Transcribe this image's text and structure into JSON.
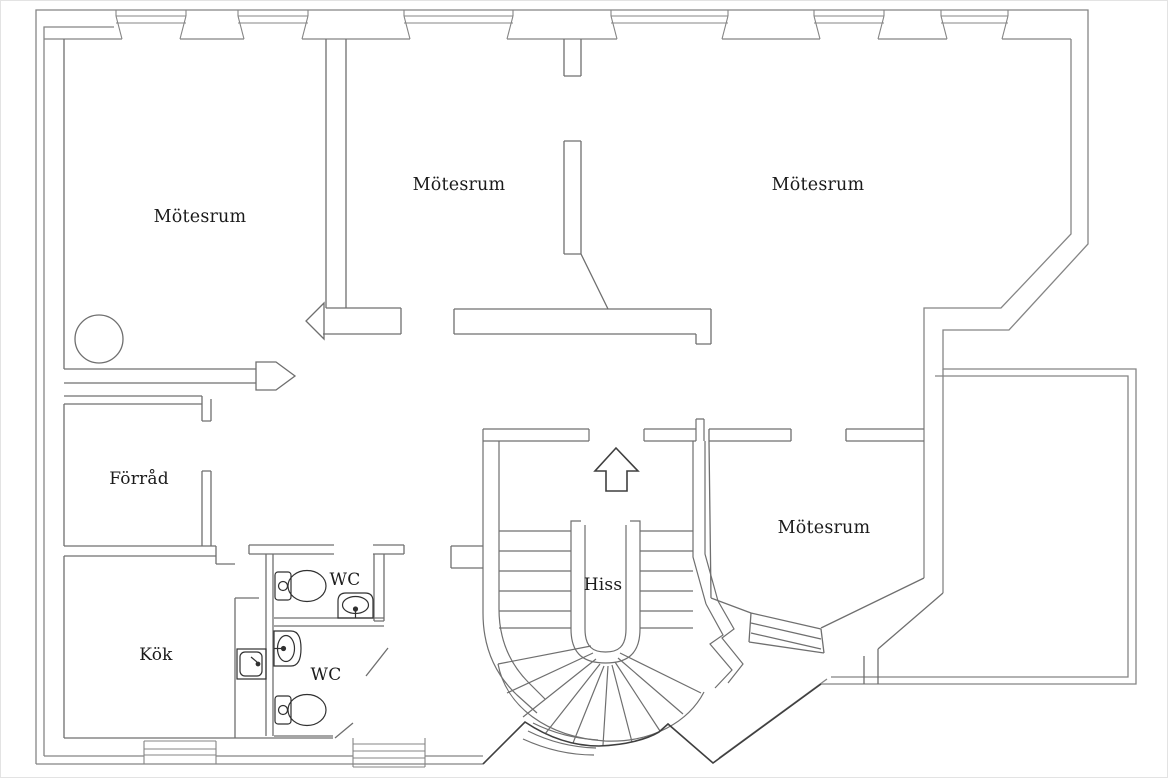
{
  "page": {
    "background": "#ffffff",
    "border_color": "#e3e3e3",
    "type_note": "architectural floor plan, office storey"
  },
  "palette": {
    "wall": "#858585",
    "wall_mid": "#6f6f6f",
    "wall_dark": "#3f3f3f",
    "fixture": "#303030",
    "text": "#1b1b1b"
  },
  "labels": {
    "meeting_room_top_left": "Mötesrum",
    "meeting_room_top_middle": "Mötesrum",
    "meeting_room_top_right": "Mötesrum",
    "meeting_room_right": "Mötesrum",
    "storage": "Förråd",
    "kitchen": "Kök",
    "wc_upper": "WC",
    "wc_lower": "WC",
    "elevator": "Hiss"
  },
  "icons": {
    "up_arrow": "entrance-direction-arrow",
    "toilet_upper": "toilet-icon",
    "toilet_lower": "toilet-icon",
    "sink_upper": "washbasin-icon",
    "sink_lower": "washbasin-icon",
    "kitchen_sink": "kitchen-sink-icon",
    "stair": "winder-staircase",
    "column_circle": "round-column"
  }
}
